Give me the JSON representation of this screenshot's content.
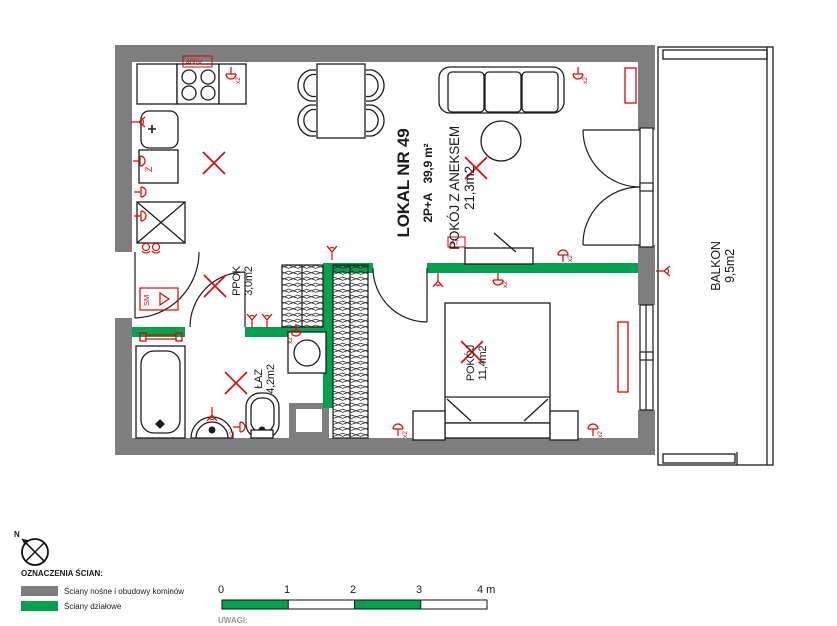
{
  "title_block": {
    "unit": "LOKAL NR 49",
    "type_area": "2P+A   39,9 m²"
  },
  "rooms": [
    {
      "id": "aneks",
      "name": "POKÓJ Z ANEKSEM",
      "area": "21,3m2"
    },
    {
      "id": "ppok",
      "name": "PPOK",
      "area": "3,0m2"
    },
    {
      "id": "laz",
      "name": "ŁAZ",
      "area": "4,2m2"
    },
    {
      "id": "pokoj",
      "name": "POKÓJ",
      "area": "11,4m2"
    },
    {
      "id": "balkon",
      "name": "BALKON",
      "area": "9,5m2"
    }
  ],
  "legend": {
    "heading": "OZNACZENIA ŚCIAN:",
    "items": [
      {
        "label": "Ściany nośne i obudowy kominów",
        "color": "#7e7e7e"
      },
      {
        "label": "Ściany działowe",
        "color": "#00a24d"
      }
    ]
  },
  "scale_bar": {
    "ticks": [
      "0",
      "1",
      "2",
      "3",
      "4 m"
    ]
  },
  "notes_heading": "UWAGI:",
  "compass": {
    "label": "N"
  },
  "electrical_labels": {
    "stove_power": "400V",
    "smoke_detector": "SM",
    "tv_outlet": "AT",
    "double_socket": "x2",
    "dishwasher": "Z"
  },
  "colors": {
    "wall_load_bearing": "#7e7e7e",
    "wall_partition": "#00a24d",
    "electrical": "#dd0606",
    "lines": "#1d1d1d"
  }
}
